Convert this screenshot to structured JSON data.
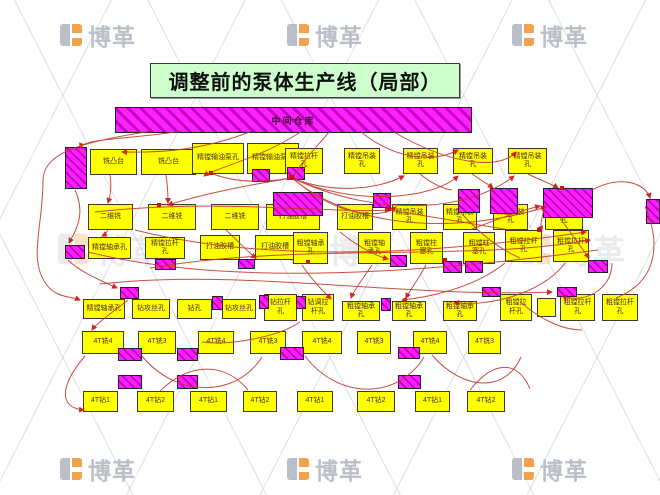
{
  "title": "调整前的泵体生产线（局部）",
  "warehouse_label": "中间仓库",
  "watermark_text": "博革",
  "colors": {
    "process_fill": "#ffff00",
    "inventory_fill": "#ff00ff",
    "title_fill": "#ccffcc",
    "arrow": "#c23b2e",
    "watermark_grey": "#b4b9c2",
    "watermark_orange": "#f0993d"
  },
  "process_boxes": [
    {
      "label": "铣凸台",
      "x": 90,
      "y": 149,
      "w": 47,
      "h": 26
    },
    {
      "label": "铣凸台",
      "x": 141,
      "y": 149,
      "w": 55,
      "h": 26
    },
    {
      "label": "精镗输油泵孔",
      "x": 192,
      "y": 143,
      "w": 52,
      "h": 31
    },
    {
      "label": "精镗输油泵孔",
      "x": 247,
      "y": 143,
      "w": 52,
      "h": 31
    },
    {
      "label": "精镗拉杆孔",
      "x": 285,
      "y": 148,
      "w": 38,
      "h": 26
    },
    {
      "label": "精镗吊装孔",
      "x": 344,
      "y": 148,
      "w": 36,
      "h": 26
    },
    {
      "label": "精镗吊装孔",
      "x": 403,
      "y": 148,
      "w": 35,
      "h": 26
    },
    {
      "label": "精镗吊装孔",
      "x": 453,
      "y": 148,
      "w": 40,
      "h": 26
    },
    {
      "label": "精镗吊装孔",
      "x": 508,
      "y": 148,
      "w": 39,
      "h": 26
    },
    {
      "label": "二维铣",
      "x": 88,
      "y": 204,
      "w": 45,
      "h": 26
    },
    {
      "label": "二维铣",
      "x": 148,
      "y": 204,
      "w": 48,
      "h": 26
    },
    {
      "label": "二维铣",
      "x": 211,
      "y": 204,
      "w": 48,
      "h": 26
    },
    {
      "label": "打油胶槽",
      "x": 266,
      "y": 204,
      "w": 54,
      "h": 26
    },
    {
      "label": "打油胶槽",
      "x": 337,
      "y": 204,
      "w": 36,
      "h": 26
    },
    {
      "label": "精镗吊装孔",
      "x": 392,
      "y": 204,
      "w": 35,
      "h": 26
    },
    {
      "label": "精镗吊装孔",
      "x": 443,
      "y": 204,
      "w": 34,
      "h": 26
    },
    {
      "label": "精镗吊装孔",
      "x": 493,
      "y": 204,
      "w": 35,
      "h": 26
    },
    {
      "label": "精镗吊装孔",
      "x": 545,
      "y": 204,
      "w": 38,
      "h": 26
    },
    {
      "label": "精镗轴承孔",
      "x": 88,
      "y": 237,
      "w": 43,
      "h": 22
    },
    {
      "label": "精镗拉杆孔",
      "x": 145,
      "y": 237,
      "w": 40,
      "h": 22
    },
    {
      "label": "打油胶槽",
      "x": 200,
      "y": 235,
      "w": 40,
      "h": 25
    },
    {
      "label": "打油胶槽",
      "x": 255,
      "y": 235,
      "w": 40,
      "h": 25
    },
    {
      "label": "粗镗轴承孔",
      "x": 293,
      "y": 232,
      "w": 35,
      "h": 32
    },
    {
      "label": "粗镗轴承孔",
      "x": 358,
      "y": 232,
      "w": 33,
      "h": 32
    },
    {
      "label": "粗镗柱塞孔",
      "x": 410,
      "y": 232,
      "w": 33,
      "h": 32
    },
    {
      "label": "粗镗柱塞孔",
      "x": 463,
      "y": 232,
      "w": 32,
      "h": 32
    },
    {
      "label": "粗镗拉杆孔",
      "x": 505,
      "y": 230,
      "w": 37,
      "h": 32
    },
    {
      "label": "粗镗拉杆孔",
      "x": 553,
      "y": 230,
      "w": 36,
      "h": 32
    },
    {
      "label": "精镗轴承孔",
      "x": 83,
      "y": 299,
      "w": 42,
      "h": 20
    },
    {
      "label": "钻攻丝孔",
      "x": 132,
      "y": 299,
      "w": 38,
      "h": 20
    },
    {
      "label": "钻孔",
      "x": 177,
      "y": 299,
      "w": 35,
      "h": 20
    },
    {
      "label": "钻攻丝孔",
      "x": 222,
      "y": 299,
      "w": 34,
      "h": 20
    },
    {
      "label": "钻拉杆孔",
      "x": 264,
      "y": 294,
      "w": 33,
      "h": 27
    },
    {
      "label": "钻调拉杆孔",
      "x": 302,
      "y": 294,
      "w": 32,
      "h": 27
    },
    {
      "label": "粗镗轴承孔",
      "x": 342,
      "y": 301,
      "w": 38,
      "h": 20
    },
    {
      "label": "粗镗轴承孔",
      "x": 392,
      "y": 301,
      "w": 34,
      "h": 20
    },
    {
      "label": "粗镗轴承孔",
      "x": 443,
      "y": 301,
      "w": 34,
      "h": 20
    },
    {
      "label": "粗镗拉杆孔",
      "x": 500,
      "y": 294,
      "w": 32,
      "h": 27
    },
    {
      "label": "",
      "x": 537,
      "y": 298,
      "w": 19,
      "h": 19
    },
    {
      "label": "粗镗拉杆孔",
      "x": 560,
      "y": 294,
      "w": 35,
      "h": 27
    },
    {
      "label": "粗镗拉杆孔",
      "x": 602,
      "y": 294,
      "w": 36,
      "h": 27
    },
    {
      "label": "4T铣4",
      "x": 82,
      "y": 331,
      "w": 42,
      "h": 23
    },
    {
      "label": "4T铣3",
      "x": 138,
      "y": 331,
      "w": 38,
      "h": 23
    },
    {
      "label": "4T铣4",
      "x": 198,
      "y": 331,
      "w": 36,
      "h": 23
    },
    {
      "label": "4T铣3",
      "x": 250,
      "y": 331,
      "w": 36,
      "h": 23
    },
    {
      "label": "4T铣4",
      "x": 302,
      "y": 331,
      "w": 40,
      "h": 23
    },
    {
      "label": "4T铣3",
      "x": 357,
      "y": 331,
      "w": 34,
      "h": 23
    },
    {
      "label": "4T铣4",
      "x": 413,
      "y": 331,
      "w": 34,
      "h": 23
    },
    {
      "label": "4T铣3",
      "x": 468,
      "y": 331,
      "w": 33,
      "h": 23
    },
    {
      "label": "4T钻1",
      "x": 83,
      "y": 391,
      "w": 35,
      "h": 21
    },
    {
      "label": "4T钻2",
      "x": 137,
      "y": 391,
      "w": 37,
      "h": 21
    },
    {
      "label": "4T钻1",
      "x": 190,
      "y": 391,
      "w": 37,
      "h": 21
    },
    {
      "label": "4T钻2",
      "x": 243,
      "y": 391,
      "w": 34,
      "h": 21
    },
    {
      "label": "4T钻1",
      "x": 297,
      "y": 391,
      "w": 36,
      "h": 21
    },
    {
      "label": "4T钻2",
      "x": 357,
      "y": 391,
      "w": 38,
      "h": 21
    },
    {
      "label": "4T钻1",
      "x": 415,
      "y": 391,
      "w": 35,
      "h": 21
    },
    {
      "label": "4T钻2",
      "x": 467,
      "y": 391,
      "w": 38,
      "h": 21
    }
  ],
  "inventory_boxes": [
    {
      "x": 65,
      "y": 147,
      "w": 22,
      "h": 42
    },
    {
      "x": 252,
      "y": 169,
      "w": 18,
      "h": 13
    },
    {
      "x": 287,
      "y": 167,
      "w": 18,
      "h": 13
    },
    {
      "x": 273,
      "y": 192,
      "w": 50,
      "h": 24
    },
    {
      "x": 373,
      "y": 193,
      "w": 18,
      "h": 15
    },
    {
      "x": 458,
      "y": 189,
      "w": 22,
      "h": 24
    },
    {
      "x": 490,
      "y": 188,
      "w": 28,
      "h": 26
    },
    {
      "x": 543,
      "y": 188,
      "w": 50,
      "h": 30
    },
    {
      "x": 646,
      "y": 199,
      "w": 14,
      "h": 25
    },
    {
      "x": 65,
      "y": 245,
      "w": 20,
      "h": 14
    },
    {
      "x": 155,
      "y": 259,
      "w": 21,
      "h": 11
    },
    {
      "x": 238,
      "y": 259,
      "w": 17,
      "h": 10
    },
    {
      "x": 390,
      "y": 255,
      "w": 17,
      "h": 12
    },
    {
      "x": 443,
      "y": 261,
      "w": 19,
      "h": 12
    },
    {
      "x": 465,
      "y": 261,
      "w": 18,
      "h": 12
    },
    {
      "x": 588,
      "y": 260,
      "w": 20,
      "h": 13
    },
    {
      "x": 120,
      "y": 287,
      "w": 19,
      "h": 12
    },
    {
      "x": 212,
      "y": 296,
      "w": 11,
      "h": 14
    },
    {
      "x": 259,
      "y": 295,
      "w": 10,
      "h": 14
    },
    {
      "x": 296,
      "y": 296,
      "w": 10,
      "h": 13
    },
    {
      "x": 381,
      "y": 298,
      "w": 10,
      "h": 13
    },
    {
      "x": 482,
      "y": 287,
      "w": 19,
      "h": 10
    },
    {
      "x": 557,
      "y": 287,
      "w": 20,
      "h": 10
    },
    {
      "x": 118,
      "y": 348,
      "w": 24,
      "h": 13
    },
    {
      "x": 177,
      "y": 348,
      "w": 21,
      "h": 13
    },
    {
      "x": 280,
      "y": 347,
      "w": 24,
      "h": 13
    },
    {
      "x": 398,
      "y": 347,
      "w": 22,
      "h": 12
    },
    {
      "x": 118,
      "y": 375,
      "w": 24,
      "h": 14
    },
    {
      "x": 177,
      "y": 375,
      "w": 21,
      "h": 14
    },
    {
      "x": 398,
      "y": 375,
      "w": 23,
      "h": 14
    }
  ]
}
